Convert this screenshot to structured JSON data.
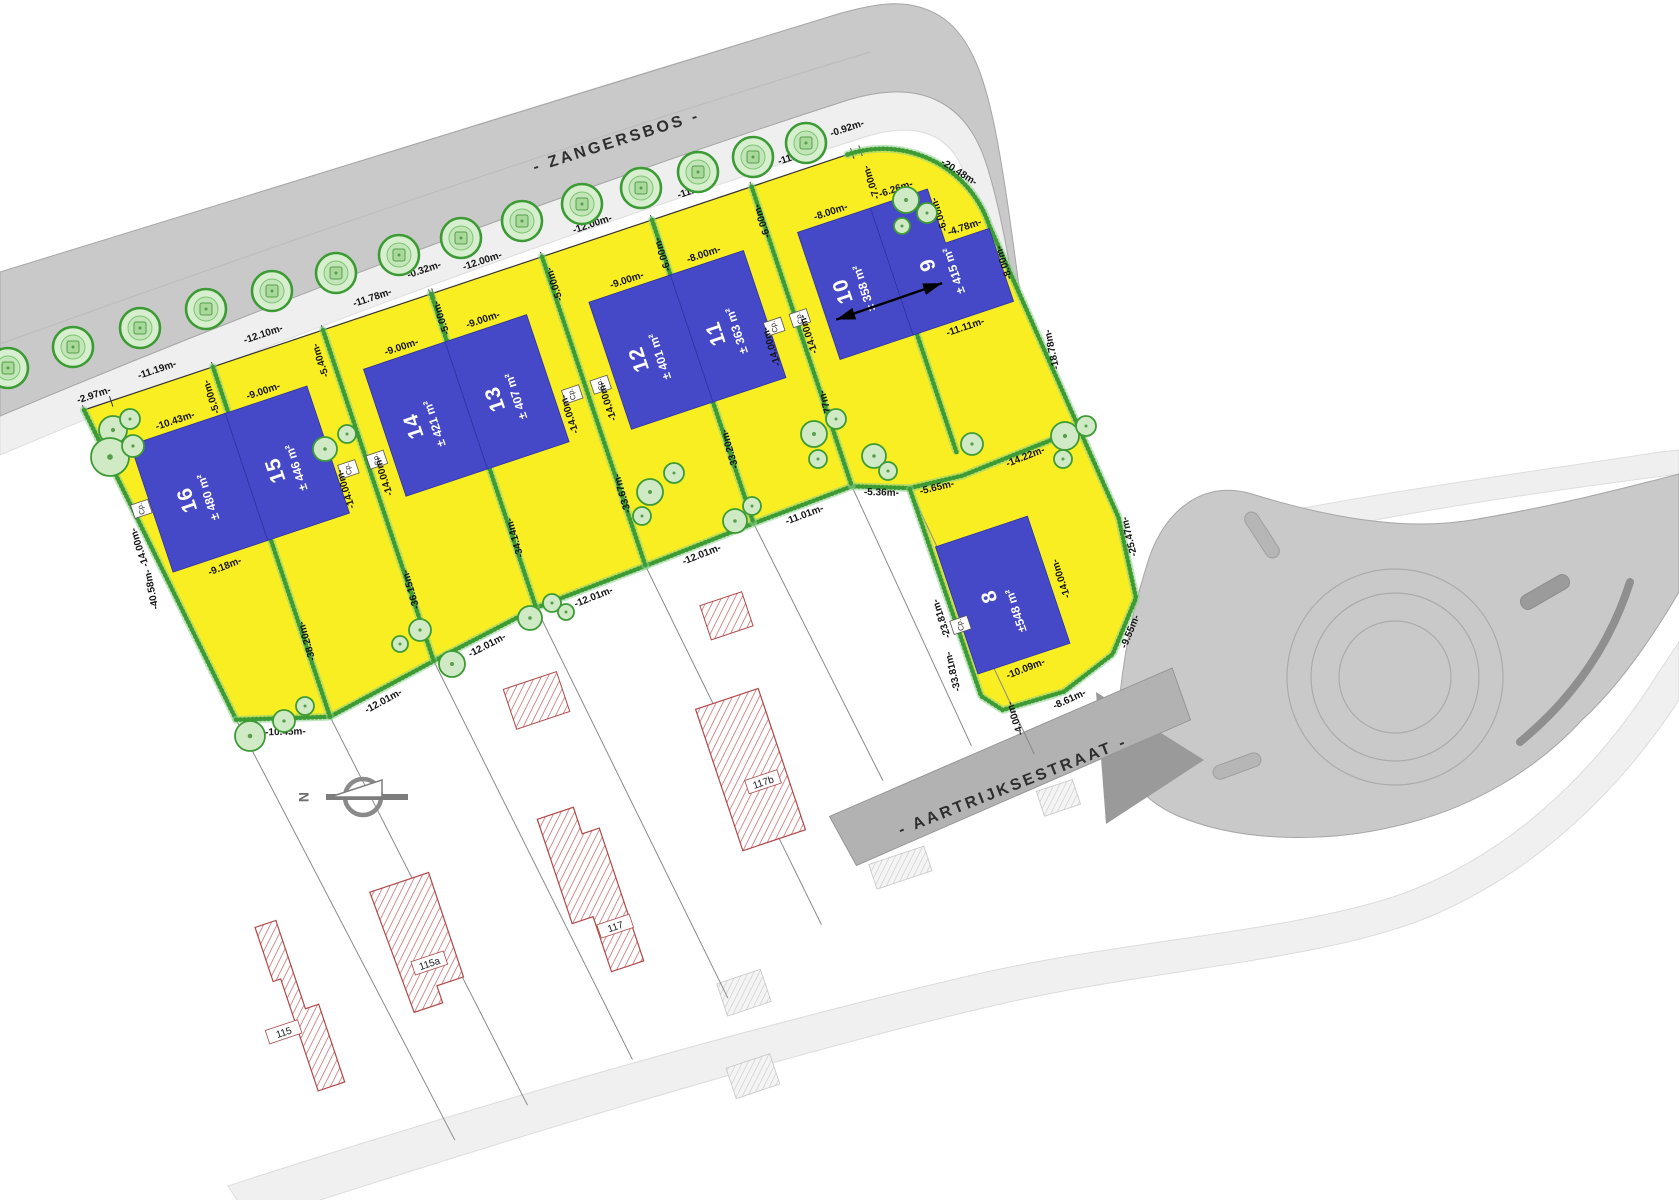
{
  "streets": {
    "top": "- ZANGERSBOS -",
    "bottom": "- AARTRIJKSESTRAAT -"
  },
  "compass": {
    "label": "N"
  },
  "cp_label": "Cp.",
  "colors": {
    "parcel_yellow": "#f8ee22",
    "building_blue": "#4549c8",
    "road_gray": "#c9c9c9",
    "road_dark": "#b2b2b2",
    "sidewalk": "#efefef",
    "hedge_green": "#3d9b35",
    "tree_fill": "#cfeac4",
    "hatch_red": "#b85555"
  },
  "lots": [
    {
      "number": "16",
      "area": "± 480 m²",
      "shape": "rect",
      "x": 33,
      "y": 48,
      "w": 100,
      "h": 134,
      "lx": 76,
      "ly": 118,
      "ax": 94,
      "ay": 122
    },
    {
      "number": "15",
      "area": "± 446 m²",
      "shape": "rect",
      "x": 133,
      "y": 48,
      "w": 86,
      "h": 134,
      "lx": 169,
      "ly": 118,
      "ax": 187,
      "ay": 122
    },
    {
      "number": "14",
      "area": "± 421 m²",
      "shape": "rect",
      "x": 278,
      "y": 50,
      "w": 86,
      "h": 134,
      "lx": 314,
      "ly": 120,
      "ax": 332,
      "ay": 124
    },
    {
      "number": "13",
      "area": "± 407 m²",
      "shape": "rect",
      "x": 364,
      "y": 50,
      "w": 86,
      "h": 134,
      "lx": 400,
      "ly": 120,
      "ax": 418,
      "ay": 124
    },
    {
      "number": "12",
      "area": "± 401 m²",
      "shape": "rect",
      "x": 513,
      "y": 58,
      "w": 86,
      "h": 134,
      "lx": 549,
      "ly": 128,
      "ax": 567,
      "ay": 132
    },
    {
      "number": "11",
      "area": "± 363 m²",
      "shape": "rect",
      "x": 599,
      "y": 58,
      "w": 77,
      "h": 134,
      "lx": 630,
      "ly": 128,
      "ax": 648,
      "ay": 132
    },
    {
      "number": "10",
      "area": "± 358 m²",
      "shape": "rect",
      "x": 733,
      "y": 58,
      "w": 77,
      "h": 134,
      "lx": 764,
      "ly": 128,
      "ax": 782,
      "ay": 132
    },
    {
      "number": "9",
      "area": "± 415 m²",
      "shape": "poly",
      "pts": "810,58 870,58 870,115 916,115 916,192 810,192",
      "lx": 853,
      "ly": 130,
      "ax": 873,
      "ay": 144
    },
    {
      "number": "8",
      "area": "±548 m²",
      "shape": "rect",
      "x": 764,
      "y": 400,
      "w": 97,
      "h": 134,
      "lx": 806,
      "ly": 464,
      "ax": 824,
      "ay": 486
    }
  ],
  "houses": [
    {
      "label": "115",
      "poly": "-2,545 20,545 20,638 34,638 34,720 6,720 6,602 -2,602",
      "lx": -8,
      "ly": 655
    },
    {
      "label": "115a",
      "poly": "118,548 180,548 180,658 152,658 152,676 122,676",
      "lx": 152,
      "ly": 636
    },
    {
      "label": "117",
      "poly": "300,532 338,532 338,560 356,560 356,700 322,700 322,642 300,642",
      "lx": 340,
      "ly": 660
    },
    {
      "label": "117b",
      "poly": "485,478 551,478 551,627 485,627",
      "lx": 526,
      "ly": 570
    }
  ],
  "sheds": [
    "309,398 365,398 365,440 309,440",
    "522,381 566,381 566,417 522,417"
  ],
  "dimensions": [
    [
      "-2.97m-",
      14,
      -8,
      0
    ],
    [
      "-11.19m-",
      82,
      -12,
      0
    ],
    [
      "-12.10m-",
      194,
      -12,
      0
    ],
    [
      "-11.78m-",
      309,
      -12,
      0
    ],
    [
      "-0.32m-",
      367,
      -22,
      0
    ],
    [
      "-12.00m-",
      425,
      -12,
      0
    ],
    [
      "-12.00m-",
      541,
      -12,
      0
    ],
    [
      "-11.00m-",
      651,
      -12,
      0
    ],
    [
      "-11.00m-",
      757,
      -12,
      0
    ],
    [
      "-0.92m-",
      813,
      -22,
      0
    ],
    [
      "-20.48m-",
      903,
      54,
      51
    ],
    [
      "-5.00m-",
      128,
      28,
      -90
    ],
    [
      "-5.40m-",
      243,
      28,
      -90
    ],
    [
      "-5.00m-",
      371,
      26,
      -90
    ],
    [
      "-5.00m-",
      489,
      30,
      -90
    ],
    [
      "-6.00m-",
      601,
      36,
      -90
    ],
    [
      "-6.00m-",
      706,
      36,
      -90
    ],
    [
      "-7.00m-",
      822,
      34,
      -90
    ],
    [
      "-6.00m-",
      876,
      86,
      -90
    ],
    [
      "-8.00m-",
      922,
      152,
      -90
    ],
    [
      "-10.43m-",
      83,
      42,
      0
    ],
    [
      "-9.00m-",
      176,
      42,
      0
    ],
    [
      "-9.00m-",
      321,
      44,
      0
    ],
    [
      "-9.00m-",
      407,
      44,
      0
    ],
    [
      "-9.00m-",
      556,
      52,
      0
    ],
    [
      "-8.00m-",
      637,
      52,
      0
    ],
    [
      "-8.00m-",
      771,
      52,
      0
    ],
    [
      "-6.26m-",
      840,
      51,
      0
    ],
    [
      "-4.78m-",
      893,
      109,
      0
    ],
    [
      "-14.00m-",
      12,
      148,
      -90
    ],
    [
      "-14.00m-",
      226,
      158,
      -90
    ],
    [
      "-14.00m-",
      266,
      158,
      -90
    ],
    [
      "-14.00m-",
      462,
      158,
      -90
    ],
    [
      "-14.00m-",
      502,
      158,
      -90
    ],
    [
      "-14.00m-",
      675,
      158,
      -90
    ],
    [
      "-14.00m-",
      714,
      158,
      -90
    ],
    [
      "-14.00m-",
      876,
      470,
      -90
    ],
    [
      "-40.58m-",
      10,
      192,
      -83
    ],
    [
      "-38.20m-",
      141,
      290,
      -88
    ],
    [
      "-36.15m-",
      256,
      274,
      -88
    ],
    [
      "-34.14m-",
      371,
      258,
      -88
    ],
    [
      "-33.67m-",
      487,
      250,
      -88
    ],
    [
      "-33.20m-",
      603,
      242,
      -88
    ],
    [
      "-32.77m-",
      708,
      236,
      -88
    ],
    [
      "-23.81m-",
      750,
      470,
      -90
    ],
    [
      "-33.81m-",
      744,
      524,
      -85
    ],
    [
      "-25.47m-",
      954,
      452,
      -85
    ],
    [
      "-18.78m-",
      940,
      250,
      -84
    ],
    [
      "-9.18m-",
      84,
      196,
      -3
    ],
    [
      "-10.45m-",
      88,
      372,
      17
    ],
    [
      "-12.01m-",
      192,
      374,
      -10
    ],
    [
      "-12.01m-",
      308,
      354,
      -9
    ],
    [
      "-12.01m-",
      424,
      342,
      -3
    ],
    [
      "-12.01m-",
      540,
      336,
      -3
    ],
    [
      "-11.01m-",
      650,
      331,
      -2
    ],
    [
      "-5.36m-",
      729,
      334,
      20
    ],
    [
      "-5.65m-",
      784,
      347,
      5
    ],
    [
      "-14.22m-",
      878,
      346,
      -3
    ],
    [
      "-11.11m-",
      862,
      204,
      0
    ],
    [
      "-10.09m-",
      811,
      547,
      -3
    ],
    [
      "-9.55m-",
      924,
      544,
      -49
    ],
    [
      "-8.61m-",
      843,
      590,
      -6
    ],
    [
      "-4.00m-",
      788,
      588,
      -90
    ]
  ],
  "cp_positions": [
    [
      23,
      112
    ],
    [
      232,
      140
    ],
    [
      262,
      140
    ],
    [
      468,
      140
    ],
    [
      498,
      140
    ],
    [
      681,
      140
    ],
    [
      708,
      140
    ],
    [
      763,
      482
    ]
  ],
  "geometry": {
    "origin": [
      84,
      410
    ],
    "rotation": -18.5,
    "yellow": "M 0 0 L 805 0 A 112 112 0 0 1 917 112 L 930 250 L 947 430 L 938 512 L 898 558 L 840 578 L 776 576 L 760 556 L 758 336 L 704 316 L 599 320 L 483 326 L 366 331 L 252 349 L 136 369 L 46 342 Z",
    "hedges": [
      "M 0 0 L 46 342",
      "M 46 342 L 136 369 L 252 349 L 366 331 L 483 326 L 599 320 L 704 316 L 758 336 L 812 341 L 947 333",
      "M 805 0 A 112 112 0 0 1 917 112 L 930 250 L 947 430 L 938 512 L 898 558 L 840 578 L 776 576 L 760 556 L 758 336",
      "M 136 0 L 136 369",
      "M 252 0 L 252 349",
      "M 366 0 L 366 331",
      "M 483 0 L 483 326",
      "M 599 0 L 599 320",
      "M 704 0 L 704 316",
      "M 814 192 L 814 318"
    ],
    "front_line": "M 0 0 L 805 0",
    "ticks": [
      0,
      28.5,
      136,
      252,
      365,
      368.3,
      483,
      599,
      704,
      810,
      818.7
    ],
    "parcel_lines": [
      [
        46,
        342,
        120,
        810
      ],
      [
        136,
        369,
        200,
        800
      ],
      [
        252,
        349,
        314,
        790
      ],
      [
        366,
        331,
        424,
        762
      ],
      [
        483,
        326,
        536,
        722
      ],
      [
        599,
        320,
        640,
        605
      ],
      [
        704,
        316,
        735,
        600
      ],
      [
        758,
        336,
        792,
        628
      ]
    ],
    "astraat_quad": "578,622 950,590 951,645 588,677",
    "astraat_label_pos": [
      762,
      656
    ],
    "gray_hatches": [
      [
        600,
        680,
        58,
        26
      ],
      [
        418,
        745,
        46,
        34
      ],
      [
        400,
        828,
        46,
        32
      ],
      [
        782,
        664,
        38,
        26
      ]
    ],
    "arrow": [
      742,
      153,
      854,
      152
    ],
    "street_label_pos": [
      618,
      146,
      -17.5
    ],
    "trees_street": [
      [
        8,
        368
      ],
      [
        73,
        347
      ],
      [
        140,
        328
      ],
      [
        206,
        309
      ],
      [
        272,
        291
      ],
      [
        336,
        273
      ],
      [
        399,
        255
      ],
      [
        461,
        238
      ],
      [
        522,
        221
      ],
      [
        582,
        204
      ],
      [
        641,
        188
      ],
      [
        698,
        172
      ],
      [
        753,
        157
      ],
      [
        806,
        143
      ]
    ],
    "trees_clusters": [
      [
        113,
        430,
        14
      ],
      [
        130,
        419,
        10
      ],
      [
        110,
        457,
        19
      ],
      [
        133,
        446,
        11
      ],
      [
        325,
        449,
        12
      ],
      [
        347,
        434,
        9
      ],
      [
        650,
        492,
        13
      ],
      [
        674,
        473,
        10
      ],
      [
        642,
        516,
        9
      ],
      [
        530,
        618,
        12
      ],
      [
        552,
        603,
        9
      ],
      [
        566,
        612,
        8
      ],
      [
        735,
        521,
        12
      ],
      [
        752,
        506,
        9
      ],
      [
        814,
        434,
        13
      ],
      [
        836,
        419,
        10
      ],
      [
        818,
        459,
        9
      ],
      [
        906,
        200,
        13
      ],
      [
        927,
        213,
        10
      ],
      [
        902,
        226,
        8
      ],
      [
        1065,
        436,
        14
      ],
      [
        1086,
        426,
        10
      ],
      [
        1063,
        459,
        9
      ],
      [
        972,
        444,
        11
      ],
      [
        874,
        456,
        12
      ],
      [
        888,
        471,
        9
      ],
      [
        250,
        736,
        15
      ],
      [
        284,
        721,
        11
      ],
      [
        305,
        706,
        9
      ],
      [
        420,
        630,
        11
      ],
      [
        400,
        644,
        8
      ],
      [
        452,
        664,
        13
      ]
    ],
    "compass_pos": [
      363,
      797
    ]
  }
}
